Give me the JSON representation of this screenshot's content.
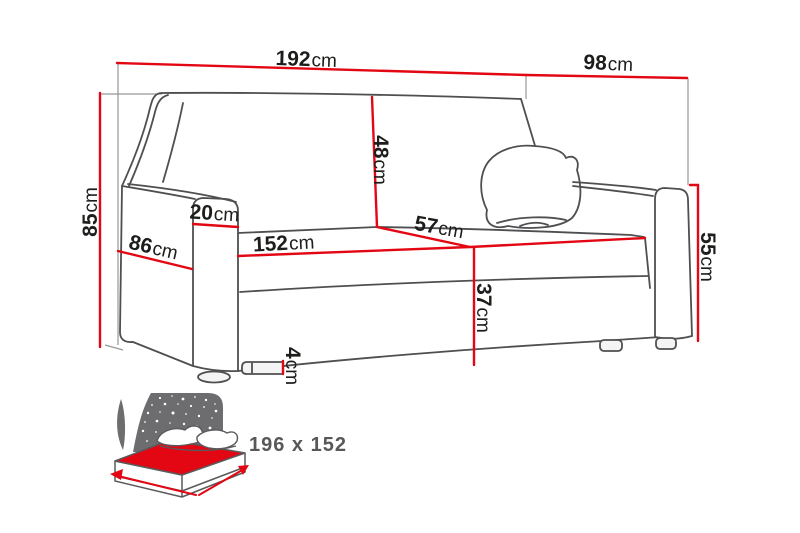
{
  "colors": {
    "dimension_red": "#e30613",
    "sofa_line_gray": "#4f4f51",
    "guide_gray": "#97979a",
    "label_black": "#1d1d1b",
    "icon_gray": "#6d6d6f",
    "icon_text_gray": "#58585a"
  },
  "dimensions": {
    "total_width": {
      "value": "192",
      "unit": "cm"
    },
    "total_depth": {
      "value": "98",
      "unit": "cm"
    },
    "total_height": {
      "value": "85",
      "unit": "cm"
    },
    "armrest_depth": {
      "value": "86",
      "unit": "cm"
    },
    "armrest_width": {
      "value": "20",
      "unit": "cm"
    },
    "backrest_height": {
      "value": "48",
      "unit": "cm"
    },
    "seat_width": {
      "value": "152",
      "unit": "cm"
    },
    "seat_depth": {
      "value": "57",
      "unit": "cm"
    },
    "seat_height": {
      "value": "37",
      "unit": "cm"
    },
    "leg_height": {
      "value": "4",
      "unit": "cm"
    },
    "armrest_height": {
      "value": "55",
      "unit": "cm"
    }
  },
  "bed_icon": {
    "sleeping_area": "196 x 152"
  }
}
